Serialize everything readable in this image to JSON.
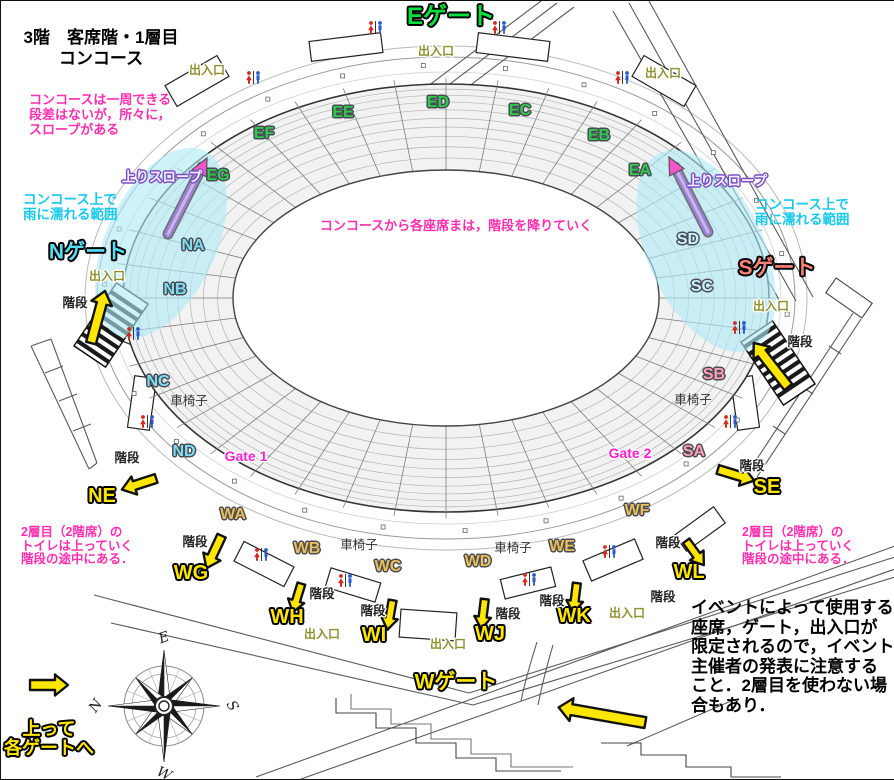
{
  "title": {
    "line1": "3階　客席階・1層目",
    "line2": "コンコース"
  },
  "colors": {
    "gateE": "#00e33e",
    "gateN": "#55ddf5",
    "gateS": "#ff8277",
    "yellow": "#ffe600",
    "secGreen": "#2ecb4f",
    "secCyan": "#7fdff2",
    "secPale": "#c9f3fb",
    "secPink": "#ffa0b5",
    "secTan": "#eac058",
    "exit": "#8f9030",
    "gatept": "#ff1ecb",
    "notePink": "#ff2fae",
    "noteCyan": "#19c9ec",
    "rampPurple": "#9b7fd4",
    "rampArrow": "#f455c8",
    "rainCyan": "#aeeaf7",
    "toiletRed": "#d42a1e",
    "toiletBlue": "#2a58c8"
  },
  "labels": [
    {
      "name": "gate-e-label",
      "theme": "gateE",
      "text": "Eゲート",
      "x": 450,
      "y": 16
    },
    {
      "name": "gate-n-label",
      "theme": "gateN",
      "text": "Nゲート",
      "x": 87,
      "y": 251
    },
    {
      "name": "gate-s-label",
      "theme": "gateS",
      "text": "Sゲート",
      "x": 776,
      "y": 267
    },
    {
      "name": "gate-w-label",
      "theme": "gateW",
      "text": "Wゲート",
      "x": 455,
      "y": 681
    },
    {
      "name": "section-eg",
      "theme": "secGreen",
      "text": "EG",
      "x": 217,
      "y": 175
    },
    {
      "name": "section-ef",
      "theme": "secGreen",
      "text": "EF",
      "x": 263,
      "y": 133
    },
    {
      "name": "section-ee",
      "theme": "secGreen",
      "text": "EE",
      "x": 342,
      "y": 112
    },
    {
      "name": "section-ed",
      "theme": "secGreen",
      "text": "ED",
      "x": 437,
      "y": 102
    },
    {
      "name": "section-ec",
      "theme": "secGreen",
      "text": "EC",
      "x": 519,
      "y": 110
    },
    {
      "name": "section-eb",
      "theme": "secGreen",
      "text": "EB",
      "x": 598,
      "y": 135
    },
    {
      "name": "section-ea",
      "theme": "secGreen",
      "text": "EA",
      "x": 639,
      "y": 170
    },
    {
      "name": "section-na",
      "theme": "secCyan",
      "text": "NA",
      "x": 192,
      "y": 245
    },
    {
      "name": "section-nb",
      "theme": "secCyan",
      "text": "NB",
      "x": 174,
      "y": 289
    },
    {
      "name": "section-nc",
      "theme": "secCyan",
      "text": "NC",
      "x": 157,
      "y": 381
    },
    {
      "name": "section-nd",
      "theme": "secCyan",
      "text": "ND",
      "x": 183,
      "y": 451
    },
    {
      "name": "section-sd",
      "theme": "secPale",
      "text": "SD",
      "x": 687,
      "y": 239
    },
    {
      "name": "section-sc",
      "theme": "secPale",
      "text": "SC",
      "x": 701,
      "y": 286
    },
    {
      "name": "section-sb",
      "theme": "secPink",
      "text": "SB",
      "x": 713,
      "y": 374
    },
    {
      "name": "section-sa",
      "theme": "secPink",
      "text": "SA",
      "x": 693,
      "y": 451
    },
    {
      "name": "section-wa",
      "theme": "secTan",
      "text": "WA",
      "x": 232,
      "y": 514
    },
    {
      "name": "section-wb",
      "theme": "secTan",
      "text": "WB",
      "x": 306,
      "y": 548
    },
    {
      "name": "section-wc",
      "theme": "secTan",
      "text": "WC",
      "x": 387,
      "y": 566
    },
    {
      "name": "section-wd",
      "theme": "secTan",
      "text": "WD",
      "x": 477,
      "y": 561
    },
    {
      "name": "section-we",
      "theme": "secTan",
      "text": "WE",
      "x": 561,
      "y": 546
    },
    {
      "name": "section-wf",
      "theme": "secTan",
      "text": "WF",
      "x": 636,
      "y": 510
    },
    {
      "name": "section-ne",
      "theme": "secYellow",
      "text": "NE",
      "x": 101,
      "y": 495
    },
    {
      "name": "section-wg",
      "theme": "secYellow",
      "text": "WG",
      "x": 190,
      "y": 572
    },
    {
      "name": "section-wh",
      "theme": "secYellow",
      "text": "WH",
      "x": 286,
      "y": 616
    },
    {
      "name": "section-wi",
      "theme": "secYellow",
      "text": "WI",
      "x": 373,
      "y": 634
    },
    {
      "name": "section-wj",
      "theme": "secYellow",
      "text": "WJ",
      "x": 489,
      "y": 633
    },
    {
      "name": "section-wk",
      "theme": "secYellow",
      "text": "WK",
      "x": 573,
      "y": 615
    },
    {
      "name": "section-wl",
      "theme": "secYellow",
      "text": "WL",
      "x": 688,
      "y": 571
    },
    {
      "name": "section-se",
      "theme": "secYellow",
      "text": "SE",
      "x": 766,
      "y": 486
    },
    {
      "name": "gate-point-1",
      "theme": "gatept",
      "text": "Gate 1",
      "x": 245,
      "y": 455
    },
    {
      "name": "gate-point-2",
      "theme": "gatept",
      "text": "Gate 2",
      "x": 629,
      "y": 452
    },
    {
      "name": "ramp-label-left",
      "theme": "rampLbl",
      "text": "上りスロープ",
      "x": 161,
      "y": 176
    },
    {
      "name": "ramp-label-right",
      "theme": "rampLbl",
      "text": "上りスロープ",
      "x": 726,
      "y": 180
    },
    {
      "name": "exit-label",
      "theme": "exit",
      "text": "出入口",
      "x": 206,
      "y": 69
    },
    {
      "name": "exit-label",
      "theme": "exit",
      "text": "出入口",
      "x": 435,
      "y": 50
    },
    {
      "name": "exit-label",
      "theme": "exit",
      "text": "出入口",
      "x": 662,
      "y": 72
    },
    {
      "name": "exit-label",
      "theme": "exit",
      "text": "出入口",
      "x": 106,
      "y": 275
    },
    {
      "name": "exit-label",
      "theme": "exit",
      "text": "出入口",
      "x": 770,
      "y": 305
    },
    {
      "name": "exit-label",
      "theme": "exit",
      "text": "出入口",
      "x": 321,
      "y": 633
    },
    {
      "name": "exit-label",
      "theme": "exit",
      "text": "出入口",
      "x": 447,
      "y": 643
    },
    {
      "name": "exit-label",
      "theme": "exit",
      "text": "出入口",
      "x": 626,
      "y": 612
    },
    {
      "name": "stairs-label",
      "theme": "stair",
      "text": "階段",
      "x": 74,
      "y": 302
    },
    {
      "name": "stairs-label",
      "theme": "stair",
      "text": "階段",
      "x": 799,
      "y": 341
    },
    {
      "name": "stairs-label",
      "theme": "stair",
      "text": "階段",
      "x": 751,
      "y": 465
    },
    {
      "name": "stairs-label",
      "theme": "stair",
      "text": "階段",
      "x": 126,
      "y": 457
    },
    {
      "name": "stairs-label",
      "theme": "stair",
      "text": "階段",
      "x": 194,
      "y": 541
    },
    {
      "name": "stairs-label",
      "theme": "stair",
      "text": "階段",
      "x": 321,
      "y": 593
    },
    {
      "name": "stairs-label",
      "theme": "stair",
      "text": "階段",
      "x": 372,
      "y": 610
    },
    {
      "name": "stairs-label",
      "theme": "stair",
      "text": "階段",
      "x": 507,
      "y": 613
    },
    {
      "name": "stairs-label",
      "theme": "stair",
      "text": "階段",
      "x": 551,
      "y": 600
    },
    {
      "name": "stairs-label",
      "theme": "stair",
      "text": "階段",
      "x": 667,
      "y": 542
    },
    {
      "name": "stairs-label",
      "theme": "stair",
      "text": "階段",
      "x": 662,
      "y": 596
    },
    {
      "name": "wheelchair-label",
      "theme": "wheel",
      "text": "車椅子",
      "x": 188,
      "y": 400
    },
    {
      "name": "wheelchair-label",
      "theme": "wheel",
      "text": "車椅子",
      "x": 692,
      "y": 399
    },
    {
      "name": "wheelchair-label",
      "theme": "wheel",
      "text": "車椅子",
      "x": 358,
      "y": 544
    },
    {
      "name": "wheelchair-label",
      "theme": "wheel",
      "text": "車椅子",
      "x": 512,
      "y": 547
    }
  ],
  "notes": [
    {
      "name": "note-concourse-loop",
      "theme": "notePink",
      "align": "left",
      "x": 28,
      "y": 91,
      "lines": [
        "コンコースは一周できる",
        "段差はないが，所々に，",
        "スロープがある"
      ]
    },
    {
      "name": "note-to-seats",
      "theme": "notePink",
      "align": "center",
      "x": 455,
      "y": 217,
      "lines": [
        "コンコースから各座席まは，階段を降りていく"
      ]
    },
    {
      "name": "note-rain-left",
      "theme": "noteCyan",
      "align": "left",
      "x": 22,
      "y": 191,
      "lines": [
        "コンコース上で",
        "雨に濡れる範囲"
      ]
    },
    {
      "name": "note-rain-right",
      "theme": "noteCyan",
      "align": "left",
      "x": 754,
      "y": 196,
      "lines": [
        "コンコース上で",
        "雨に濡れる範囲"
      ]
    },
    {
      "name": "note-tier2-left",
      "theme": "notePink2",
      "align": "left",
      "x": 20,
      "y": 525,
      "lines": [
        "2層目（2階席）の",
        "トイレは上っていく",
        "階段の途中にある．"
      ]
    },
    {
      "name": "note-tier2-right",
      "theme": "notePink2",
      "align": "left",
      "x": 741,
      "y": 525,
      "lines": [
        "2層目（2階席）の",
        "トイレは上っていく",
        "階段の途中にある．"
      ]
    },
    {
      "name": "note-event",
      "theme": "noteBlack",
      "align": "left",
      "x": 690,
      "y": 597,
      "lines": [
        "イベントによって使用する",
        "座席，ゲート，出入口が",
        "限定されるので，イベント",
        "主催者の発表に注意する",
        "こと．2層目を使わない場",
        "合もあり．"
      ]
    },
    {
      "name": "note-up-to-gates",
      "theme": "noteYellow ol-k",
      "align": "center",
      "x": 48,
      "y": 719,
      "lines": [
        "上って",
        "各ゲートへ"
      ]
    }
  ],
  "toilets": [
    {
      "x": 366,
      "y": 20
    },
    {
      "x": 490,
      "y": 20
    },
    {
      "x": 244,
      "y": 70
    },
    {
      "x": 613,
      "y": 70
    },
    {
      "x": 124,
      "y": 326
    },
    {
      "x": 138,
      "y": 414
    },
    {
      "x": 730,
      "y": 320
    },
    {
      "x": 721,
      "y": 414
    },
    {
      "x": 252,
      "y": 547
    },
    {
      "x": 336,
      "y": 573
    },
    {
      "x": 520,
      "y": 572
    },
    {
      "x": 600,
      "y": 544
    }
  ],
  "arrows": [
    {
      "name": "stairs-arrow-n",
      "x": 97,
      "y": 316,
      "rot": -75,
      "len": 54,
      "w": 10
    },
    {
      "name": "stairs-arrow-s",
      "x": 770,
      "y": 364,
      "rot": -128,
      "len": 56,
      "w": 10
    },
    {
      "name": "stairs-arrow-se",
      "x": 735,
      "y": 474,
      "rot": 17,
      "len": 38,
      "w": 9
    },
    {
      "name": "stairs-arrow-ne",
      "x": 138,
      "y": 483,
      "rot": 162,
      "len": 36,
      "w": 9
    },
    {
      "name": "stairs-arrow-wg",
      "x": 213,
      "y": 551,
      "rot": 115,
      "len": 36,
      "w": 9
    },
    {
      "name": "stairs-arrow-wh",
      "x": 296,
      "y": 597,
      "rot": 107,
      "len": 30,
      "w": 8
    },
    {
      "name": "stairs-arrow-wi",
      "x": 389,
      "y": 614,
      "rot": 100,
      "len": 30,
      "w": 8
    },
    {
      "name": "stairs-arrow-wj",
      "x": 482,
      "y": 613,
      "rot": 97,
      "len": 30,
      "w": 8
    },
    {
      "name": "stairs-arrow-wk",
      "x": 574,
      "y": 597,
      "rot": 97,
      "len": 30,
      "w": 8
    },
    {
      "name": "stairs-arrow-wl",
      "x": 694,
      "y": 552,
      "rot": 54,
      "len": 30,
      "w": 8
    },
    {
      "name": "flow-arrow-sw",
      "x": 601,
      "y": 714,
      "rot": 190,
      "len": 88,
      "w": 11
    },
    {
      "name": "up-to-gates-arrow",
      "x": 48,
      "y": 684,
      "rot": 0,
      "len": 38,
      "w": 10
    }
  ],
  "ramps": [
    {
      "name": "up-ramp-left",
      "x1": 167,
      "y1": 233,
      "x2": 201,
      "y2": 166,
      "ax": 206,
      "ay": 157,
      "arot": -63
    },
    {
      "name": "up-ramp-right",
      "x1": 707,
      "y1": 231,
      "x2": 674,
      "y2": 166,
      "ax": 668,
      "ay": 156,
      "arot": -117
    }
  ],
  "rain_zones": [
    {
      "name": "rain-zone-left",
      "cx": 160,
      "cy": 242,
      "rx": 55,
      "ry": 102,
      "rot": 25
    },
    {
      "name": "rain-zone-right",
      "cx": 705,
      "cy": 250,
      "rx": 58,
      "ry": 108,
      "rot": -25
    }
  ],
  "kiosks": [
    {
      "x": 345,
      "y": 46,
      "w": 72,
      "h": 20,
      "r": -7
    },
    {
      "x": 512,
      "y": 46,
      "w": 72,
      "h": 20,
      "r": 7
    },
    {
      "x": 196,
      "y": 80,
      "w": 60,
      "h": 24,
      "r": -30
    },
    {
      "x": 663,
      "y": 80,
      "w": 60,
      "h": 24,
      "r": 30
    },
    {
      "x": 172,
      "y": 232,
      "w": 48,
      "h": 20,
      "r": -42
    },
    {
      "x": 713,
      "y": 232,
      "w": 48,
      "h": 20,
      "r": 42
    },
    {
      "x": 136,
      "y": 318,
      "w": 52,
      "h": 22,
      "r": -68
    },
    {
      "x": 748,
      "y": 318,
      "w": 52,
      "h": 22,
      "r": 68
    },
    {
      "x": 141,
      "y": 402,
      "w": 52,
      "h": 22,
      "r": -82
    },
    {
      "x": 744,
      "y": 402,
      "w": 52,
      "h": 22,
      "r": 82
    },
    {
      "x": 263,
      "y": 563,
      "w": 56,
      "h": 22,
      "r": 27
    },
    {
      "x": 352,
      "y": 584,
      "w": 52,
      "h": 20,
      "r": 17
    },
    {
      "x": 427,
      "y": 624,
      "w": 56,
      "h": 28,
      "r": 4
    },
    {
      "x": 527,
      "y": 582,
      "w": 52,
      "h": 20,
      "r": -14
    },
    {
      "x": 612,
      "y": 559,
      "w": 56,
      "h": 22,
      "r": -23
    },
    {
      "x": 699,
      "y": 528,
      "w": 48,
      "h": 20,
      "r": -36
    }
  ],
  "stairs_hatch": [
    {
      "name": "n-gate-stairs",
      "x": 110,
      "y": 324,
      "rot": -56
    },
    {
      "name": "s-gate-stairs",
      "x": 777,
      "y": 362,
      "rot": 56
    }
  ],
  "compass": {
    "x": 163,
    "y": 705,
    "letters": [
      {
        "t": "E",
        "angle": -90,
        "rot": -20
      },
      {
        "t": "S",
        "angle": 0,
        "rot": 60
      },
      {
        "t": "W",
        "angle": 90,
        "rot": 25
      },
      {
        "t": "N",
        "angle": 180,
        "rot": -55
      }
    ]
  },
  "bowl": {
    "cx": 445,
    "cy": 297,
    "rx": 323,
    "ry": 214,
    "field_rx": 213,
    "field_ry": 128,
    "spokes": 40,
    "rows": [
      0.14,
      0.27,
      0.39,
      0.5,
      0.6,
      0.7,
      0.79,
      0.87,
      0.94
    ]
  }
}
